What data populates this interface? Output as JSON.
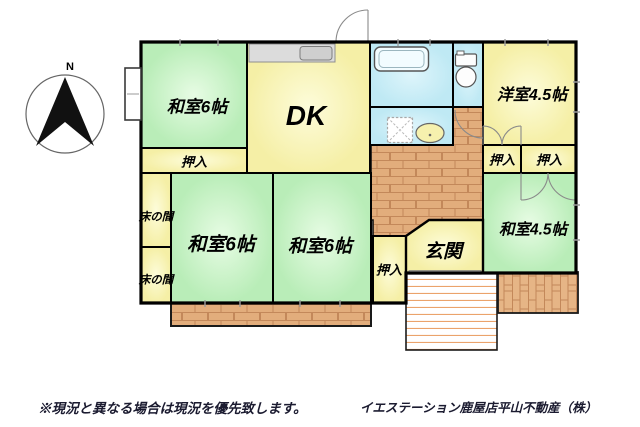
{
  "compass": {
    "north_label": "N"
  },
  "rooms": {
    "washitsu6_top": "和室6帖",
    "dk": "DK",
    "yoshitsu45": "洋室4.5帖",
    "washitsu6_left": "和室6帖",
    "washitsu6_mid": "和室6帖",
    "washitsu45": "和室4.5帖",
    "genkan": "玄関",
    "oshiire_top": "押入",
    "oshiire_mid": "押入",
    "oshiire_right1": "押入",
    "oshiire_right2": "押入",
    "tokonoma1": "床の間",
    "tokonoma2": "床の間"
  },
  "footer": {
    "disclaimer": "※現況と異なる場合は現況を優先致します。",
    "company": "イエステーション鹿屋店平山不動産（株）"
  },
  "colors": {
    "tatami_green": "#cdf2cb",
    "room_cream": "#f9f4b8",
    "water_blue": "#c9edf6",
    "floor_brick": "#e2ad7c",
    "wall": "#000000"
  }
}
